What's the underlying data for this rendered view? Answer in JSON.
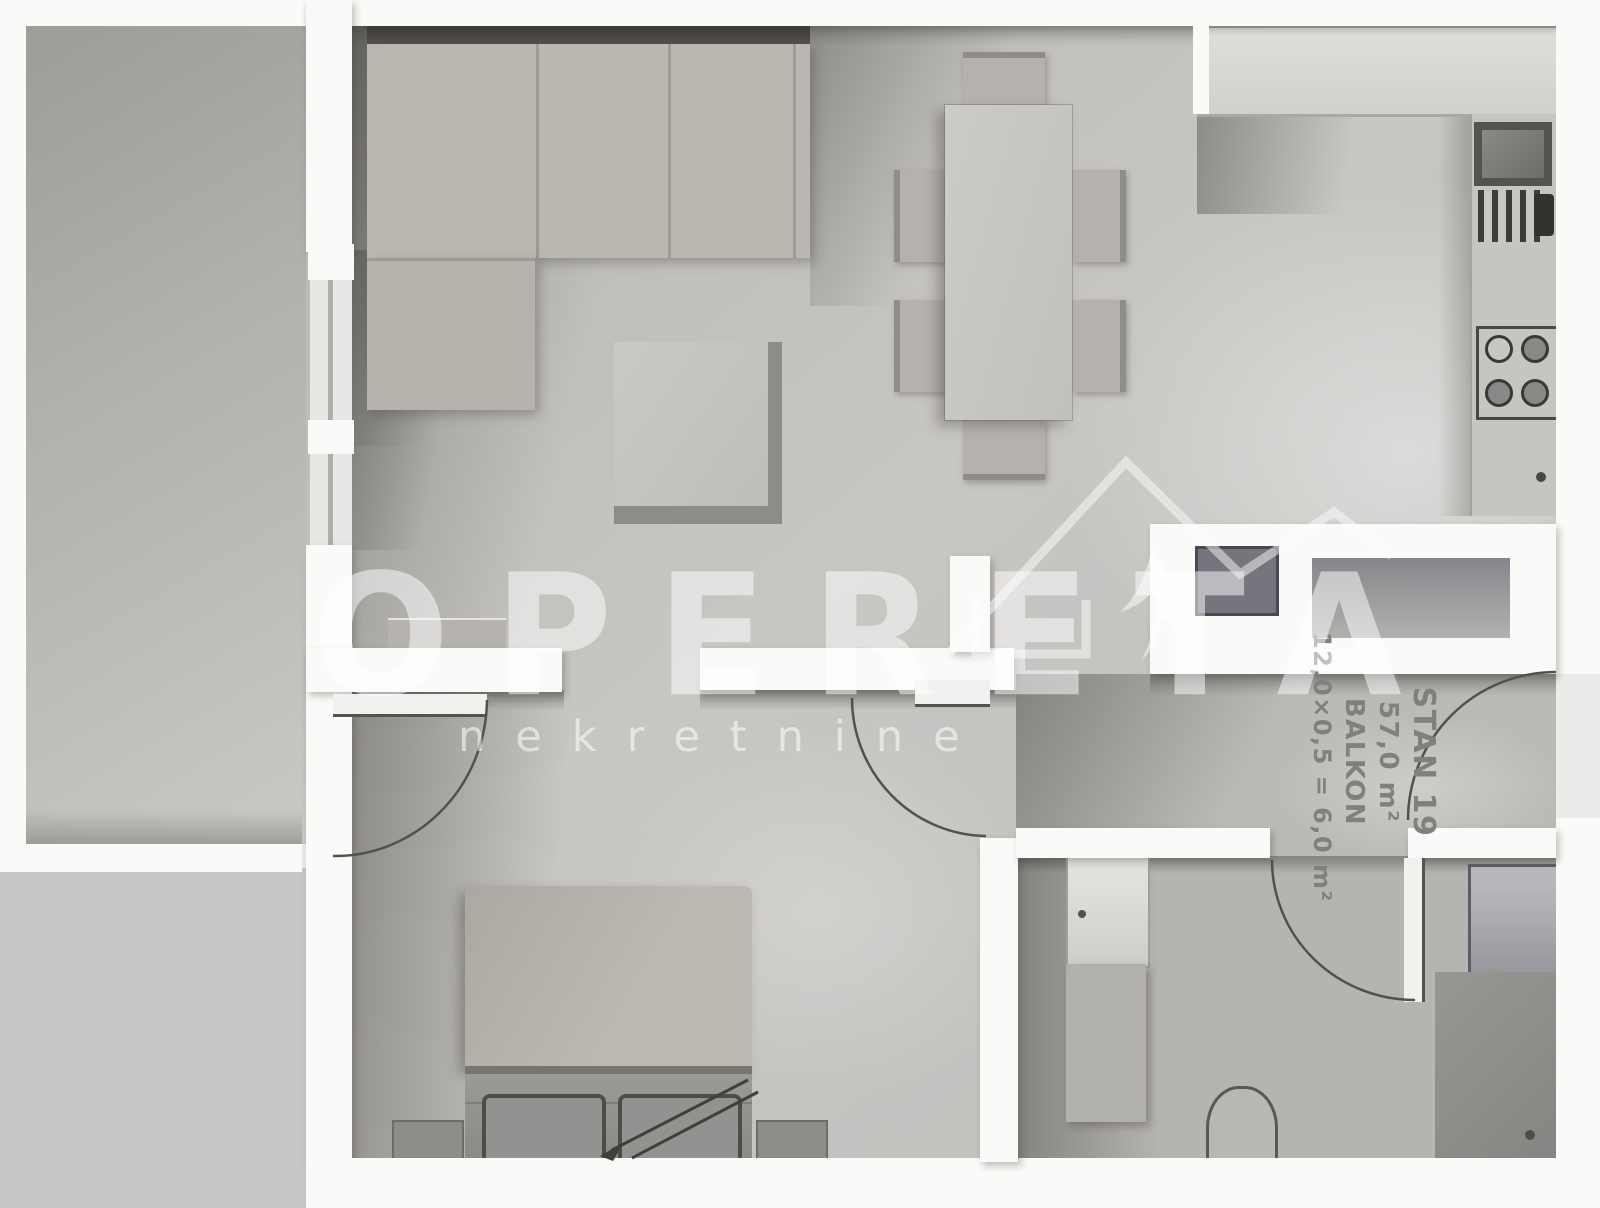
{
  "watermark": {
    "brand": "OPERETA",
    "tagline": "nekretnine",
    "logo_icon": "house-swallow-logo"
  },
  "unit_label": {
    "name": "STAN 19",
    "area": "57,0 m²",
    "balcony_label": "BALKON",
    "balcony_calc": "12,0×0,5 = 6,0 m²"
  },
  "palette": {
    "outside": "#ecebe9",
    "wall": "#fafaf8",
    "floor": "#c6c4c1",
    "balcony": "#aeacab",
    "furniture": "#b9b6b0",
    "outline": "#4c4a47",
    "labeltext": "#82807c"
  }
}
